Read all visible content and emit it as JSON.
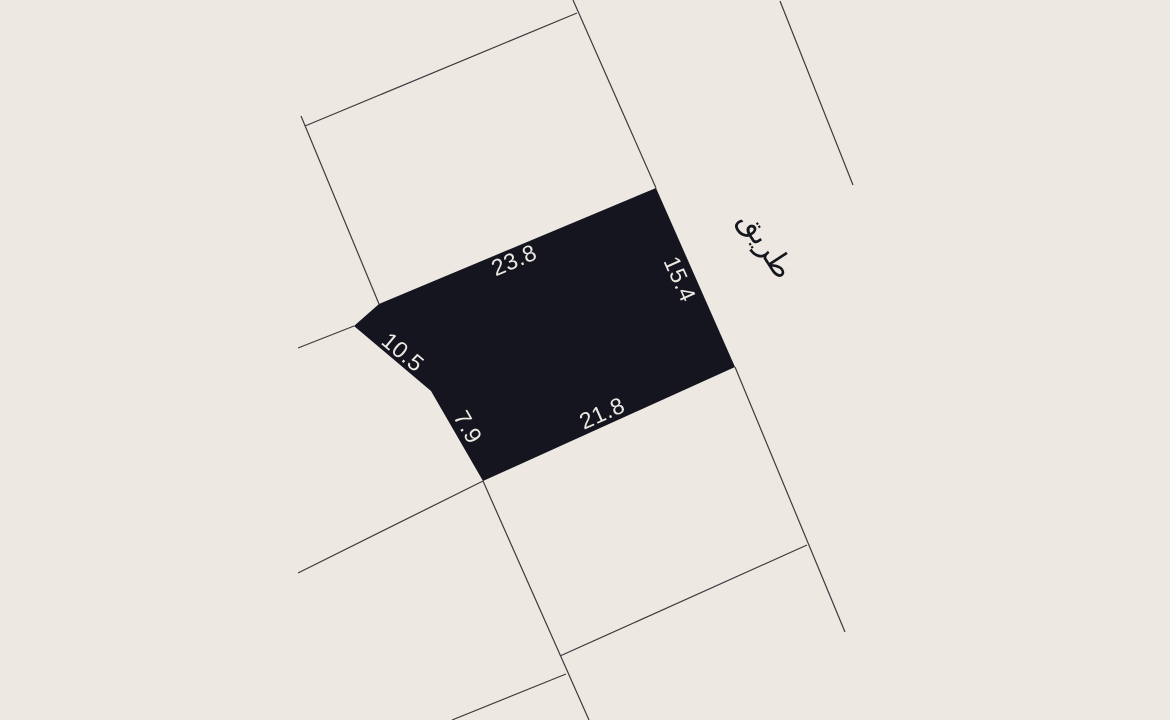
{
  "map": {
    "background_color": "#EDE9E2",
    "parcel": {
      "fill_color": "#14151F",
      "points": [
        [
          354,
          326
        ],
        [
          379,
          304
        ],
        [
          656,
          188
        ],
        [
          735,
          367
        ],
        [
          483,
          481
        ],
        [
          431,
          391
        ]
      ],
      "label_color": "#EDE9E2",
      "label_font_size": 23,
      "dimension_labels": [
        {
          "text": "23.8",
          "x": 514,
          "y": 260,
          "rotate": -23
        },
        {
          "text": "15.4",
          "x": 680,
          "y": 279,
          "rotate": 66
        },
        {
          "text": "10.5",
          "x": 403,
          "y": 352,
          "rotate": 40
        },
        {
          "text": "7.9",
          "x": 468,
          "y": 427,
          "rotate": 60
        },
        {
          "text": "21.8",
          "x": 602,
          "y": 413,
          "rotate": -24
        }
      ]
    },
    "road_label": {
      "text": "طريق",
      "x": 766,
      "y": 245,
      "rotate": 57,
      "color": "#16161E",
      "font_size": 30
    },
    "boundary_lines": {
      "color": "#3B3B3F",
      "width": 1.2,
      "segments": [
        {
          "x1": 305,
          "y1": 126,
          "x2": 577,
          "y2": 13
        },
        {
          "x1": 301,
          "y1": 116,
          "x2": 379,
          "y2": 304
        },
        {
          "x1": 573,
          "y1": 0,
          "x2": 656,
          "y2": 188
        },
        {
          "x1": 735,
          "y1": 367,
          "x2": 845,
          "y2": 632
        },
        {
          "x1": 780,
          "y1": 1,
          "x2": 853,
          "y2": 185
        },
        {
          "x1": 298,
          "y1": 348,
          "x2": 354,
          "y2": 326
        },
        {
          "x1": 483,
          "y1": 481,
          "x2": 298,
          "y2": 573
        },
        {
          "x1": 483,
          "y1": 481,
          "x2": 589,
          "y2": 720
        },
        {
          "x1": 560,
          "y1": 656,
          "x2": 807,
          "y2": 545
        },
        {
          "x1": 566,
          "y1": 674,
          "x2": 452,
          "y2": 720
        }
      ]
    }
  }
}
